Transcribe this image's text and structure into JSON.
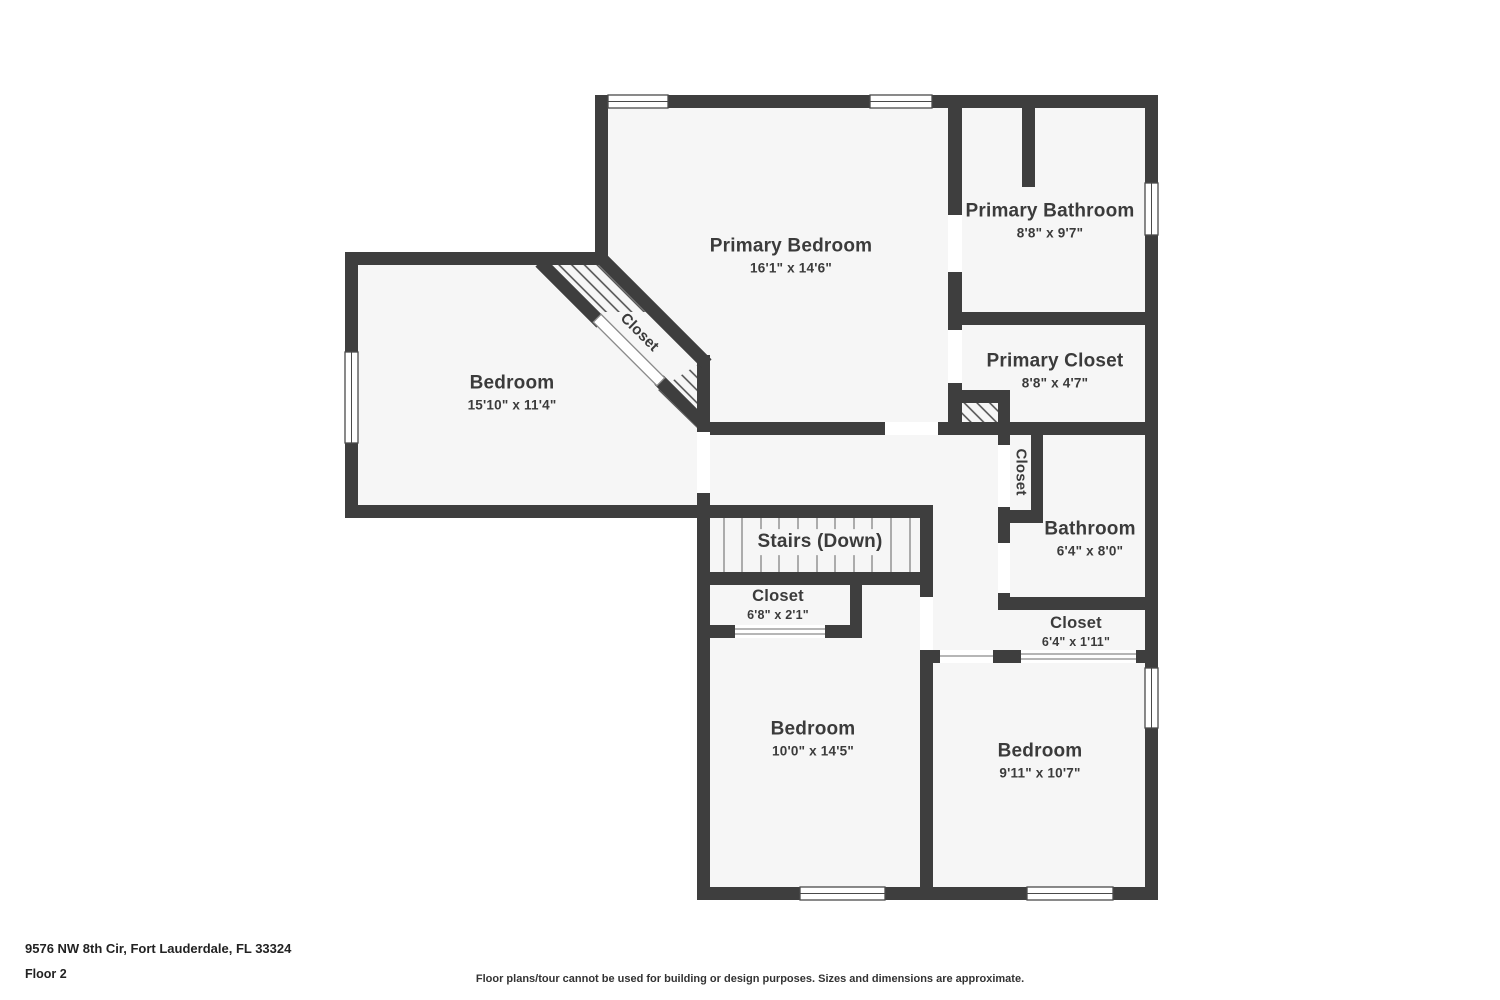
{
  "address": "9576 NW 8th Cir, Fort Lauderdale, FL 33324",
  "floor_label": "Floor 2",
  "disclaimer": "Floor plans/tour cannot be used for building or design purposes. Sizes and dimensions are approximate.",
  "colors": {
    "wall": "#3e3e3e",
    "room_fill": "#f6f6f6",
    "hatch_line": "#4a4a4a",
    "tread": "#949494",
    "label_text": "#3b3b3b"
  },
  "rooms": {
    "primary_bedroom": {
      "name": "Primary Bedroom",
      "dims": "16'1\" x 14'6\""
    },
    "primary_bathroom": {
      "name": "Primary Bathroom",
      "dims": "8'8\" x 9'7\""
    },
    "primary_closet": {
      "name": "Primary Closet",
      "dims": "8'8\" x 4'7\""
    },
    "bedroom_left": {
      "name": "Bedroom",
      "dims": "15'10\" x 11'4\""
    },
    "closet_diagonal": {
      "name": "Closet"
    },
    "stairs": {
      "name": "Stairs (Down)"
    },
    "closet_hall": {
      "name": "Closet",
      "dims": "6'8\" x 2'1\""
    },
    "closet_linen": {
      "name": "Closet"
    },
    "bathroom": {
      "name": "Bathroom",
      "dims": "6'4\" x 8'0\""
    },
    "closet_small": {
      "name": "Closet",
      "dims": "6'4\" x 1'11\""
    },
    "bedroom_bottom_left": {
      "name": "Bedroom",
      "dims": "10'0\" x 14'5\""
    },
    "bedroom_bottom_right": {
      "name": "Bedroom",
      "dims": "9'11\" x 10'7\""
    }
  }
}
